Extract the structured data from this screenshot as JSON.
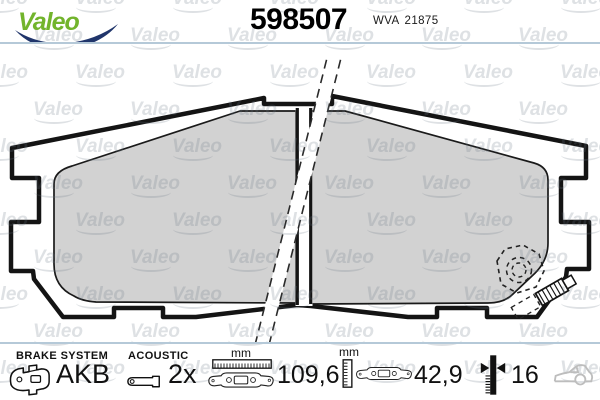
{
  "brand": {
    "logo_text": "Valeo"
  },
  "watermark": {
    "text": "Valeo"
  },
  "header": {
    "part_number": "598507",
    "wva_label": "WVA",
    "wva_number": "21875"
  },
  "footer": {
    "brake_system": {
      "label": "BRAKE SYSTEM",
      "value": "AKB"
    },
    "acoustic": {
      "label": "ACOUSTIC",
      "value": "2x"
    },
    "width": {
      "unit": "mm",
      "value": "109,6"
    },
    "height": {
      "unit": "mm",
      "value": "42,9"
    },
    "thickness": {
      "value": "16"
    }
  },
  "colors": {
    "valeo_green": "#72b42c",
    "swoosh_blue": "#20356b",
    "separator_blue": "#b5c9d8",
    "pad_gray": "#d2d2d2",
    "line_black": "#141414",
    "car_gray": "#bdbdbd"
  }
}
